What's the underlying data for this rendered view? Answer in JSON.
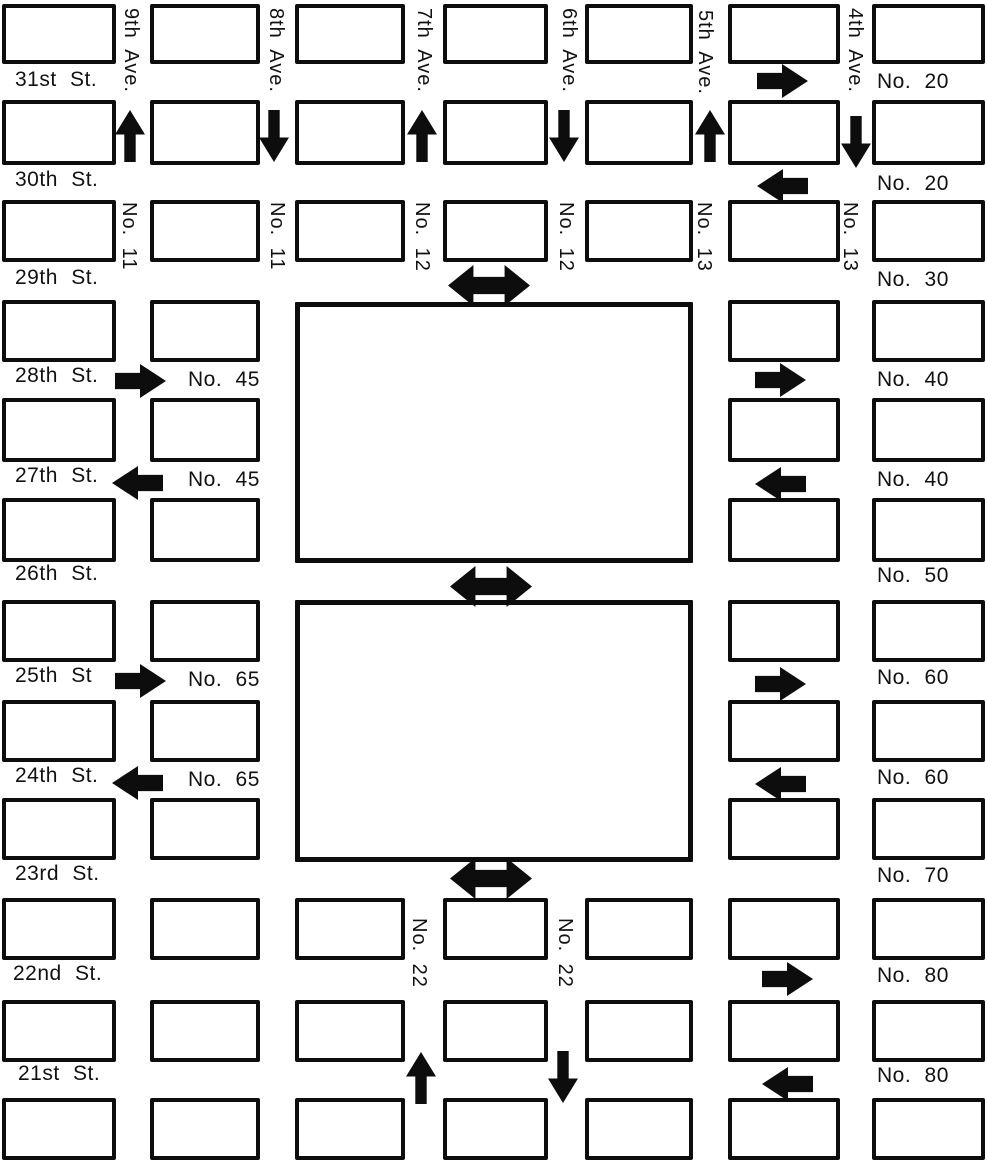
{
  "canvas": {
    "width": 987,
    "height": 1165,
    "background": "#ffffff",
    "ink": "#0d0d0d"
  },
  "grid": {
    "columns": [
      {
        "x": 2,
        "w": 114
      },
      {
        "x": 150,
        "w": 110
      },
      {
        "x": 295,
        "w": 110
      },
      {
        "x": 443,
        "w": 105
      },
      {
        "x": 585,
        "w": 108
      },
      {
        "x": 728,
        "w": 112
      },
      {
        "x": 872,
        "w": 113
      }
    ],
    "rows": [
      {
        "y": 4,
        "h": 60
      },
      {
        "y": 100,
        "h": 65
      },
      {
        "y": 200,
        "h": 62
      },
      {
        "y": 300,
        "h": 62
      },
      {
        "y": 398,
        "h": 64
      },
      {
        "y": 498,
        "h": 64
      },
      {
        "y": 600,
        "h": 62
      },
      {
        "y": 700,
        "h": 62
      },
      {
        "y": 798,
        "h": 62
      },
      {
        "y": 898,
        "h": 62
      },
      {
        "y": 1000,
        "h": 62
      },
      {
        "y": 1098,
        "h": 62
      }
    ],
    "full_block_rows": [
      0,
      1,
      2,
      9,
      10,
      11
    ],
    "park_rows": [
      3,
      4,
      5,
      6,
      7,
      8
    ],
    "park_row_columns": [
      0,
      1,
      5,
      6
    ]
  },
  "parks": [
    {
      "x": 295,
      "y": 302,
      "w": 398,
      "h": 261
    },
    {
      "x": 295,
      "y": 600,
      "w": 398,
      "h": 262
    }
  ],
  "street_labels": [
    {
      "label": "31st St.",
      "x": 15,
      "y": 68
    },
    {
      "label": "30th St.",
      "x": 15,
      "y": 168
    },
    {
      "label": "29th St.",
      "x": 15,
      "y": 266
    },
    {
      "label": "28th St.",
      "x": 15,
      "y": 364
    },
    {
      "label": "27th St.",
      "x": 15,
      "y": 464
    },
    {
      "label": "26th St.",
      "x": 15,
      "y": 562
    },
    {
      "label": "25th St",
      "x": 15,
      "y": 664
    },
    {
      "label": "24th St.",
      "x": 15,
      "y": 764
    },
    {
      "label": "23rd St.",
      "x": 15,
      "y": 862
    },
    {
      "label": "22nd St.",
      "x": 13,
      "y": 962
    },
    {
      "label": "21st St.",
      "x": 18,
      "y": 1062
    }
  ],
  "route_labels_right": [
    {
      "label": "No. 20",
      "x": 877,
      "y": 70
    },
    {
      "label": "No. 20",
      "x": 877,
      "y": 172
    },
    {
      "label": "No. 30",
      "x": 877,
      "y": 268
    },
    {
      "label": "No. 40",
      "x": 877,
      "y": 368
    },
    {
      "label": "No. 40",
      "x": 877,
      "y": 468
    },
    {
      "label": "No. 50",
      "x": 877,
      "y": 564
    },
    {
      "label": "No. 60",
      "x": 877,
      "y": 666
    },
    {
      "label": "No. 60",
      "x": 877,
      "y": 766
    },
    {
      "label": "No. 70",
      "x": 877,
      "y": 864
    },
    {
      "label": "No. 80",
      "x": 877,
      "y": 964
    },
    {
      "label": "No. 80",
      "x": 877,
      "y": 1064
    }
  ],
  "route_labels_left": [
    {
      "label": "No. 45",
      "x": 188,
      "y": 368
    },
    {
      "label": "No. 45",
      "x": 188,
      "y": 468
    },
    {
      "label": "No. 65",
      "x": 188,
      "y": 668
    },
    {
      "label": "No. 65",
      "x": 188,
      "y": 768
    }
  ],
  "avenue_labels": [
    {
      "label": "9th Ave.",
      "x": 142,
      "y": 8
    },
    {
      "label": "8th Ave.",
      "x": 287,
      "y": 8
    },
    {
      "label": "7th Ave.",
      "x": 435,
      "y": 8
    },
    {
      "label": "6th Ave.",
      "x": 580,
      "y": 8
    },
    {
      "label": "5th Ave.",
      "x": 716,
      "y": 10
    },
    {
      "label": "4th Ave.",
      "x": 866,
      "y": 8
    }
  ],
  "avenue_route_labels": [
    {
      "label": "No. 11",
      "x": 140,
      "y": 202
    },
    {
      "label": "No. 11",
      "x": 288,
      "y": 202
    },
    {
      "label": "No. 12",
      "x": 433,
      "y": 202
    },
    {
      "label": "No. 12",
      "x": 577,
      "y": 202
    },
    {
      "label": "No. 13",
      "x": 715,
      "y": 202
    },
    {
      "label": "No. 13",
      "x": 861,
      "y": 202
    },
    {
      "label": "No. 22",
      "x": 430,
      "y": 918
    },
    {
      "label": "No. 22",
      "x": 576,
      "y": 918
    }
  ],
  "arrows": [
    {
      "name": "arrow-up-9th-ave",
      "dir": "up",
      "x": 115,
      "y": 110
    },
    {
      "name": "arrow-down-8th-ave",
      "dir": "down",
      "x": 259,
      "y": 110
    },
    {
      "name": "arrow-up-7th-ave",
      "dir": "up",
      "x": 407,
      "y": 110
    },
    {
      "name": "arrow-down-6th-ave",
      "dir": "down",
      "x": 549,
      "y": 110
    },
    {
      "name": "arrow-up-5th-ave",
      "dir": "up",
      "x": 695,
      "y": 110
    },
    {
      "name": "arrow-down-4th-ave",
      "dir": "down",
      "x": 841,
      "y": 116
    },
    {
      "name": "arrow-east-31st-st",
      "dir": "right",
      "x": 757,
      "y": 64
    },
    {
      "name": "arrow-west-30th-st",
      "dir": "left",
      "x": 757,
      "y": 169
    },
    {
      "name": "arrow-east-28th-st-left",
      "dir": "right",
      "x": 115,
      "y": 364
    },
    {
      "name": "arrow-east-28th-st-right",
      "dir": "right",
      "x": 755,
      "y": 363
    },
    {
      "name": "arrow-west-27th-st-left",
      "dir": "left",
      "x": 112,
      "y": 466
    },
    {
      "name": "arrow-west-27th-st-right",
      "dir": "left",
      "x": 755,
      "y": 467
    },
    {
      "name": "arrow-east-25th-st-left",
      "dir": "right",
      "x": 115,
      "y": 664
    },
    {
      "name": "arrow-east-25th-st-right",
      "dir": "right",
      "x": 755,
      "y": 667
    },
    {
      "name": "arrow-west-24th-st-left",
      "dir": "left",
      "x": 112,
      "y": 766
    },
    {
      "name": "arrow-west-24th-st-right",
      "dir": "left",
      "x": 755,
      "y": 767
    },
    {
      "name": "arrow-east-22nd-st",
      "dir": "right",
      "x": 762,
      "y": 962
    },
    {
      "name": "arrow-west-21st-st",
      "dir": "left",
      "x": 762,
      "y": 1067
    },
    {
      "name": "arrow-up-7th-ave-south",
      "dir": "up",
      "x": 406,
      "y": 1052
    },
    {
      "name": "arrow-down-6th-ave-south",
      "dir": "down",
      "x": 548,
      "y": 1051
    },
    {
      "name": "arrow-two-way-29th-st",
      "dir": "both",
      "x": 448,
      "y": 265
    },
    {
      "name": "arrow-two-way-26th-st",
      "dir": "both",
      "x": 450,
      "y": 566
    },
    {
      "name": "arrow-two-way-23rd-st",
      "dir": "both",
      "x": 450,
      "y": 858
    }
  ]
}
